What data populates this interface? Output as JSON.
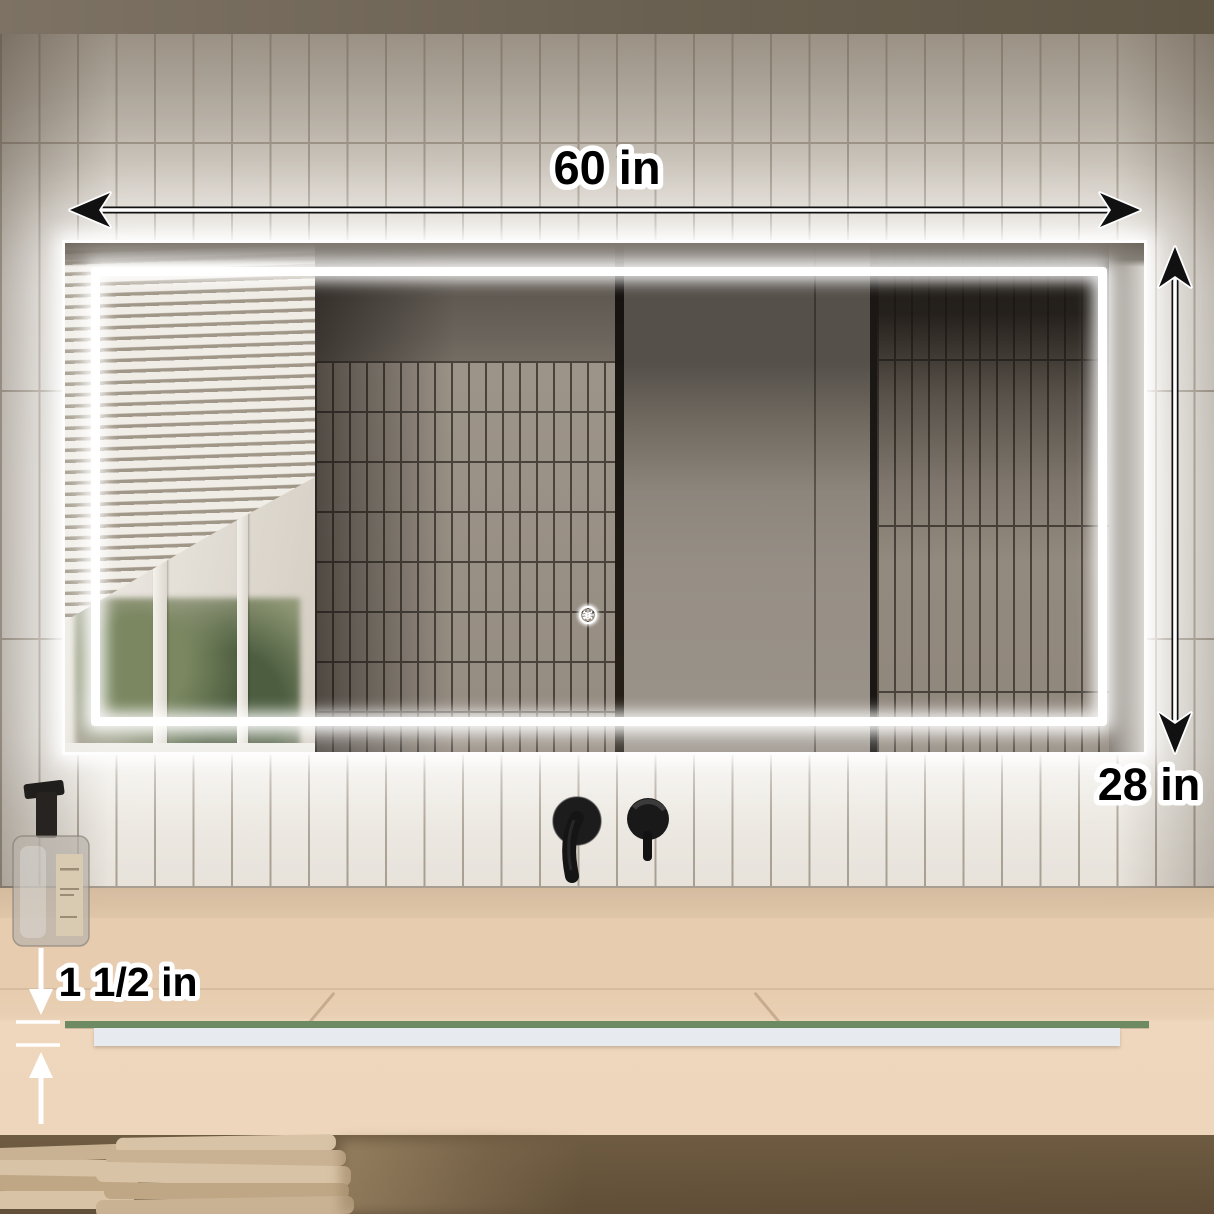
{
  "scene": {
    "description": "LED bathroom mirror product photo with dimension callouts",
    "annotations": {
      "width": "60 in",
      "height": "28 in",
      "thickness": "1 1/2 in"
    },
    "mirror": {
      "led_color": "#ffffff",
      "glass_edge_color": "#6d8a63",
      "touch_icons": [
        {
          "name": "brightness-icon"
        },
        {
          "name": "power-color-temp-icon"
        },
        {
          "name": "defog-icon"
        }
      ]
    },
    "room": {
      "wall_tile_color": "#e9e4dc",
      "grout_color": "#a79e91",
      "counter_color": "#e9cfb3",
      "fixtures": [
        "soap-dispenser",
        "wall-mounted-faucet",
        "folded-towels"
      ]
    }
  }
}
